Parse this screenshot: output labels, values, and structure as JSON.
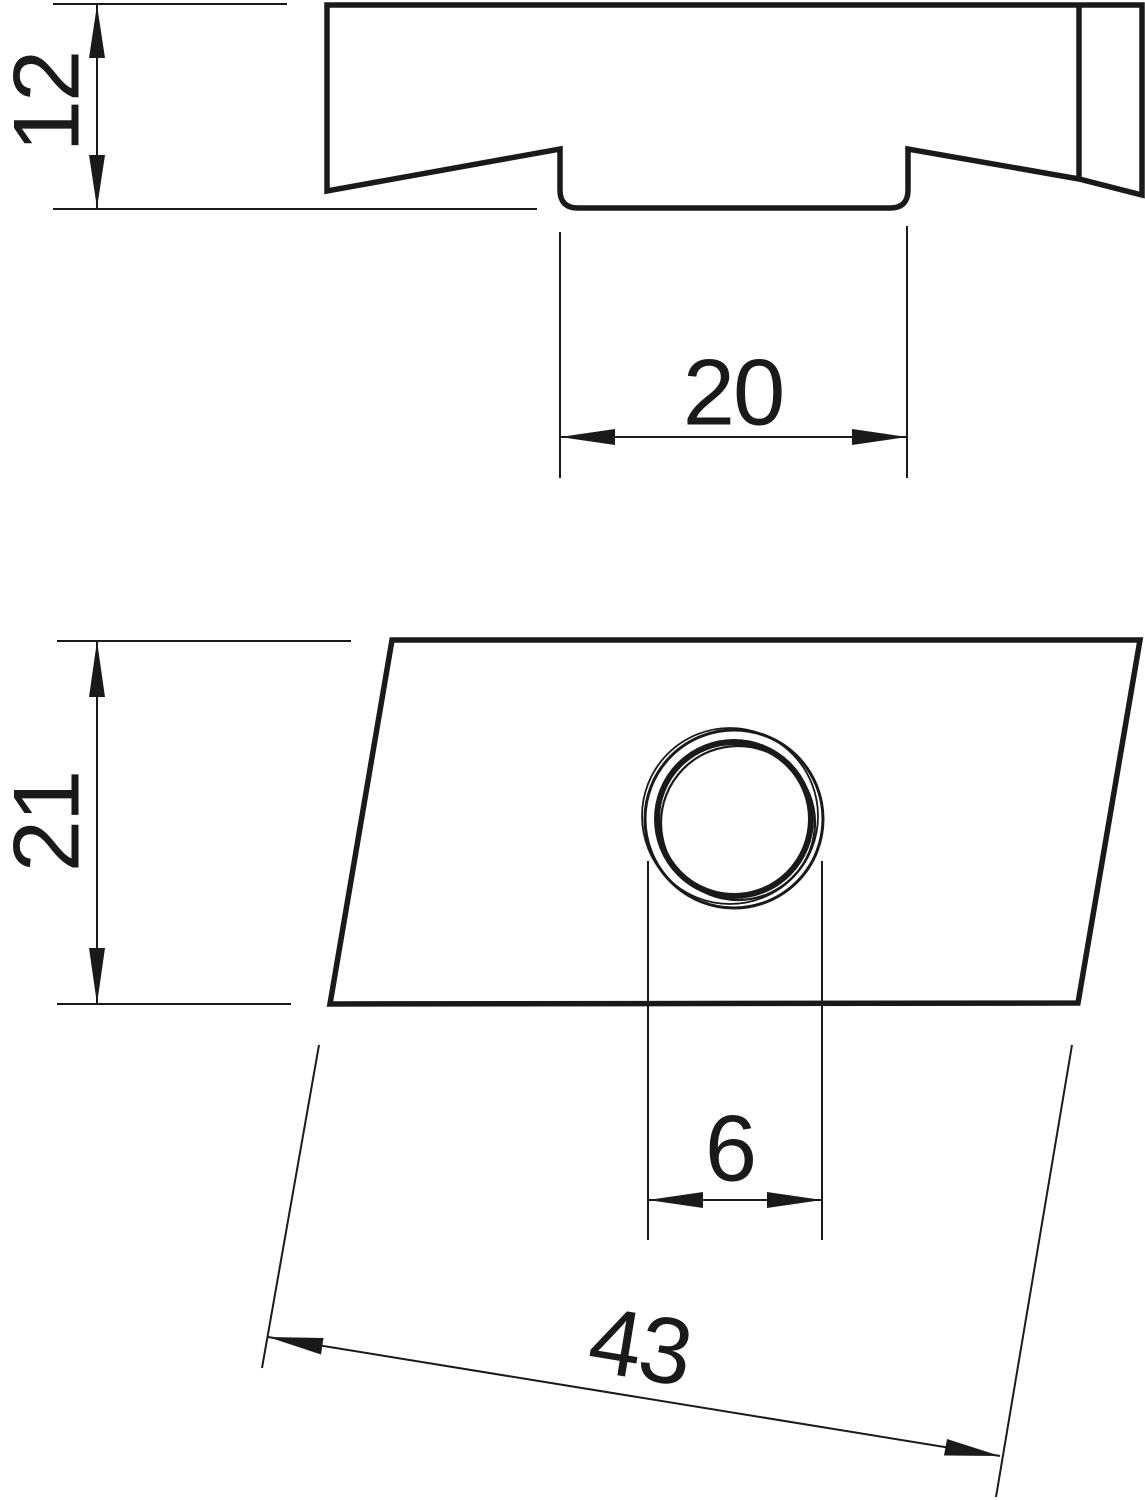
{
  "drawing": {
    "type": "technical-dimension-drawing",
    "background_color": "#ffffff",
    "line_color": "#1a1a18",
    "views": [
      {
        "id": "side-profile-view",
        "description": "side profile of sliding nut with channel groove"
      },
      {
        "id": "plan-view",
        "description": "parallelogram plan view of sliding nut with threaded hole"
      }
    ],
    "dimensions": {
      "profile_height": {
        "value": "12"
      },
      "slot_width": {
        "value": "20"
      },
      "plate_width": {
        "value": "21"
      },
      "thread_size": {
        "value": "6"
      },
      "plate_length": {
        "value": "43"
      }
    }
  }
}
